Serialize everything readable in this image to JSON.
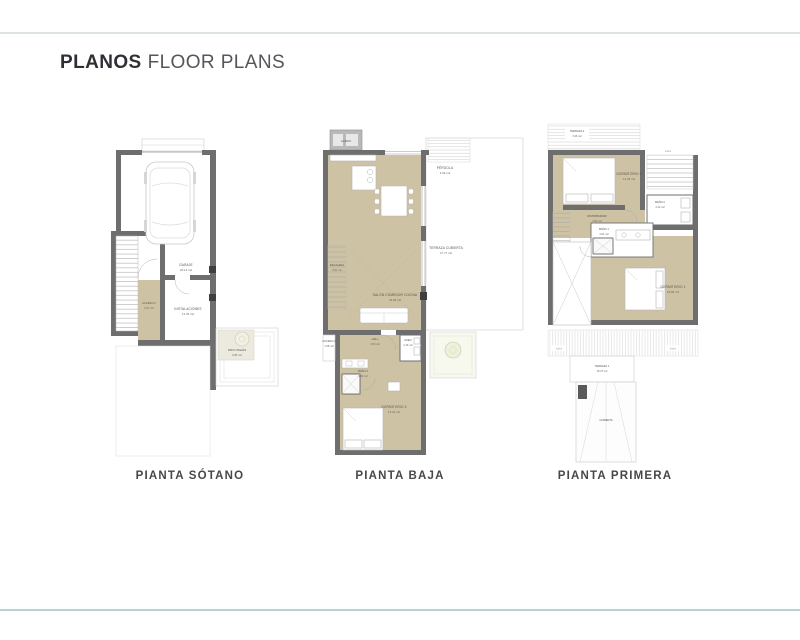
{
  "header": {
    "title_bold": "PLANOS",
    "title_regular": "FLOOR PLANS"
  },
  "colors": {
    "wall": "#6e6e6e",
    "room_beige": "#cec2a4",
    "rule_top": "#dde3e4",
    "rule_bottom": "#b7d0da"
  },
  "plans": [
    {
      "caption": "PIANTA SÓTANO",
      "rooms": [
        {
          "name": "GARAJE",
          "area": "30.14 m2"
        },
        {
          "name": "ACCESO 2",
          "area": "6.67 m2"
        },
        {
          "name": "INSTALACIONES",
          "area": "14.45 m2"
        },
        {
          "name": "PATIO INGLÉS",
          "area": "8.85 m2"
        }
      ]
    },
    {
      "caption": "PIANTA BAJA",
      "rooms": [
        {
          "name": "LAVADO"
        },
        {
          "name": "PÉRGOLA",
          "area": "4.09 m2"
        },
        {
          "name": "ESCALERA",
          "area": "9.51 m2"
        },
        {
          "name": "SALÓN COMEDOR COCINA",
          "area": "45.68 m2"
        },
        {
          "name": "TERRAZA CUBIERTA",
          "area": "17.77 m2"
        },
        {
          "name": "ACCESO 1",
          "area": "1.68 m2"
        },
        {
          "name": "HALL",
          "area": "3.59 m2"
        },
        {
          "name": "ASEO",
          "area": "2.16 m2"
        },
        {
          "name": "BAÑO 3",
          "area": "3.09 m2"
        },
        {
          "name": "DORMITORIO 3",
          "area": "13.36 m2"
        }
      ]
    },
    {
      "caption": "PIANTA PRIMERA",
      "rooms": [
        {
          "name": "TERRAZA 2",
          "area": "3.36 m2"
        },
        {
          "name": "DORMITORIO 2",
          "area": "14.28 m2"
        },
        {
          "name": "BAÑO 2",
          "area": "4.13 m2"
        },
        {
          "name": "DISTRIBUIDOR",
          "area": "4.59 m2"
        },
        {
          "name": "BAÑO 1",
          "area": "3.64 m2"
        },
        {
          "name": "DORMITORIO 1",
          "area": "18.85 m2"
        },
        {
          "name": "TERRAZA 1",
          "area": "15.37 m2"
        },
        {
          "name": "CUBIERTA"
        }
      ],
      "annotations": [
        "stairs",
        "stairs",
        "stairs"
      ]
    }
  ]
}
